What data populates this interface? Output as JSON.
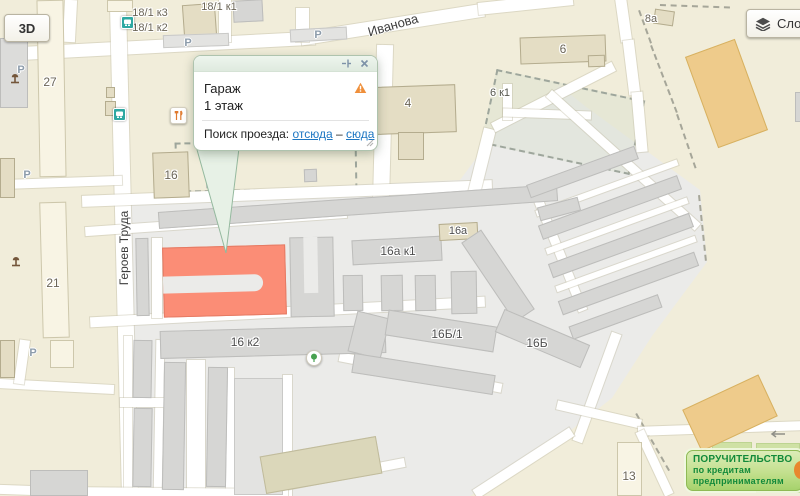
{
  "controls": {
    "view_3d": "3D",
    "layers": "Слои"
  },
  "balloon": {
    "title": "Гараж",
    "subtitle": "1 этаж",
    "route_label": "Поиск проезда:",
    "link_from": "отсюда",
    "dash": "–",
    "link_to": "сюда"
  },
  "streets": {
    "ivanova": "Иванова",
    "geroev_truda": "Героев Труда"
  },
  "map_labels": {
    "b18_1_k3": "18/1 к3",
    "b18_1_k2": "18/1 к2",
    "b18_1_k1": "18/1 к1",
    "b27": "27",
    "b21": "21",
    "b16": "16",
    "b4": "4",
    "b6": "6",
    "b6k1": "6 к1",
    "b8a": "8а",
    "b16a": "16а",
    "b16a_k1": "16а к1",
    "b16k2": "16 к2",
    "b16b1": "16Б/1",
    "b16b": "16Б",
    "b13": "13",
    "parking": "P"
  },
  "banner": {
    "line1": "ПОРУЧИТЕЛЬСТВО",
    "line2": "по кредитам",
    "line3": "предпринимателям"
  },
  "colors": {
    "highlight_building": "#fb8d76",
    "balloon_border": "#aec3ae",
    "link": "#1d76c2",
    "warning": "#ef8f3b",
    "banner_text": "#128a3a",
    "bus_icon": "#2ea8a2"
  }
}
